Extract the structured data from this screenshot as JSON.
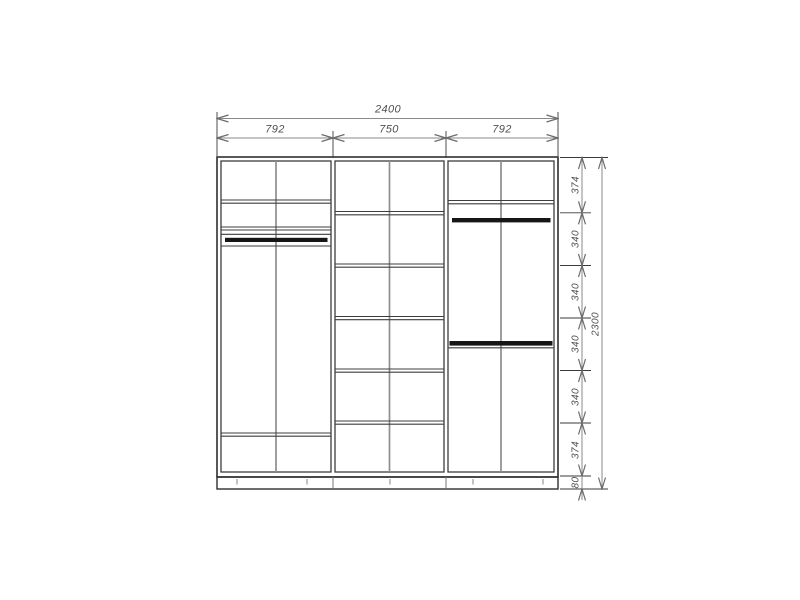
{
  "dimensions": {
    "top": {
      "total": "2400",
      "sections": [
        "792",
        "750",
        "792"
      ]
    },
    "right": {
      "segments": [
        "374",
        "340",
        "340",
        "340",
        "340",
        "374"
      ],
      "plinth": "80",
      "total": "2300"
    }
  },
  "colors": {
    "outline": "#2f2f2f",
    "shelf_line": "#3d3d3d",
    "divider": "#8e8e8e",
    "rod": "#161616",
    "dimension_line": "#8a8a8a",
    "extension_line": "#3a3a3a",
    "dimension_text": "#4f4f4f",
    "background": "#ffffff"
  }
}
